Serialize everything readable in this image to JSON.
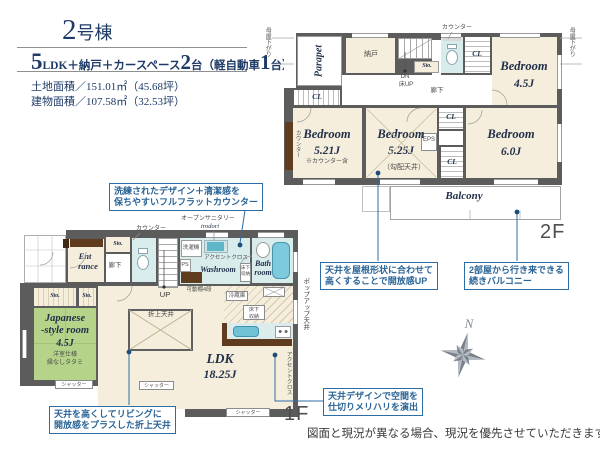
{
  "header": {
    "building_no": "2",
    "building_suffix": "号棟",
    "spec_n1": "5",
    "spec_t1": "LDK＋納戸＋カースペース",
    "spec_n2": "2",
    "spec_t2": "台（軽自動車",
    "spec_n3": "1",
    "spec_t3": "台）",
    "land_area": "土地面積／151.01㎡（45.68坪）",
    "building_area": "建物面積／107.58㎡（32.53坪）"
  },
  "floor2": {
    "label": "2F",
    "moya_left": "母屋下がり",
    "moya_right": "母屋下がり",
    "parapet": "Parapet",
    "nando": "納戸",
    "counter": "カウンター",
    "sto": "Sto.",
    "dn": "DN",
    "floor_up": "床UP",
    "hallway": "廊下",
    "cl_top": "CL",
    "cl_left": "CL",
    "cl_mid": "CL",
    "cl_low": "CL",
    "eps": "EPS",
    "bedroom1_name": "Bedroom",
    "bedroom1_size": "4.5J",
    "bedroom2_name": "Bedroom",
    "bedroom2_size": "5.21J",
    "bedroom2_note": "※カウンター含",
    "bedroom2_counter": "カウンター",
    "bedroom3_name": "Bedroom",
    "bedroom3_size": "5.25J",
    "bedroom3_note": "（勾配天井）",
    "bedroom4_name": "Bedroom",
    "bedroom4_size": "6.0J",
    "balcony": "Balcony"
  },
  "floor1": {
    "label": "1F",
    "counter": "カウンター",
    "open_sanitary": "オープンサニタリー",
    "open_sanitary_brand": "irodori",
    "sto_top": "Sto.",
    "sto_left1": "Sto.",
    "sto_left2": "Sto.",
    "entrance_line1": "Ent",
    "entrance_line2": "rance",
    "hallway": "廊下",
    "up": "UP",
    "washer": "洗濯機",
    "accent_cloth1": "アクセントクロス",
    "ps": "PS",
    "washroom": "Washroom",
    "underfloor_wash_l1": "床下",
    "underfloor_wash_l2": "収納",
    "shelf": "可動棚4段",
    "bath_line1": "Bath",
    "bath_line2": "room",
    "japanese_line1": "Japanese",
    "japanese_line2": "-style room",
    "japanese_size": "4.5J",
    "japanese_note1": "洋室仕様",
    "japanese_note2": "縁なしタタミ",
    "oriage": "折上天井",
    "ldk_name": "LDK",
    "ldk_size": "18.25J",
    "fridge": "冷蔵庫",
    "underfloor_kitchen_l1": "床下",
    "underfloor_kitchen_l2": "収納",
    "popup_ceiling": "ポップアップ天井",
    "accent_cloth2": "アクセントクロス",
    "shutter1": "シャッター",
    "shutter2": "シャッター",
    "shutter3": "シャッター"
  },
  "callouts": {
    "counter_l1": "洗練されたデザイン＋清潔感を",
    "counter_l2": "保ちやすいフルフラットカウンター",
    "roof_l1": "天井を屋根形状に合わせて",
    "roof_l2": "高くすることで開放感UP",
    "balcony_l1": "2部屋から行き来できる",
    "balcony_l2": "続きバルコニー",
    "ceiling_design_l1": "天井デザインで空間を",
    "ceiling_design_l2": "仕切りメリハリを演出",
    "living_l1": "天井を高くしてリビングに",
    "living_l2": "開放感をプラスした折上天井"
  },
  "compass": {
    "north": "N"
  },
  "footer": {
    "disclaimer": "図面と現況が異なる場合、現況を優先させていただきます。"
  },
  "colors": {
    "accent_blue": "#2e6da4",
    "navy_text": "#1e3a66",
    "wall_gray": "#5c5c5c",
    "room_beige": "#f5eedc",
    "tatami_green": "#b5d489",
    "wet_cyan": "#d8ecec",
    "fixture_teal": "#6fc3d4",
    "wood_brown": "#5f3c1e"
  }
}
